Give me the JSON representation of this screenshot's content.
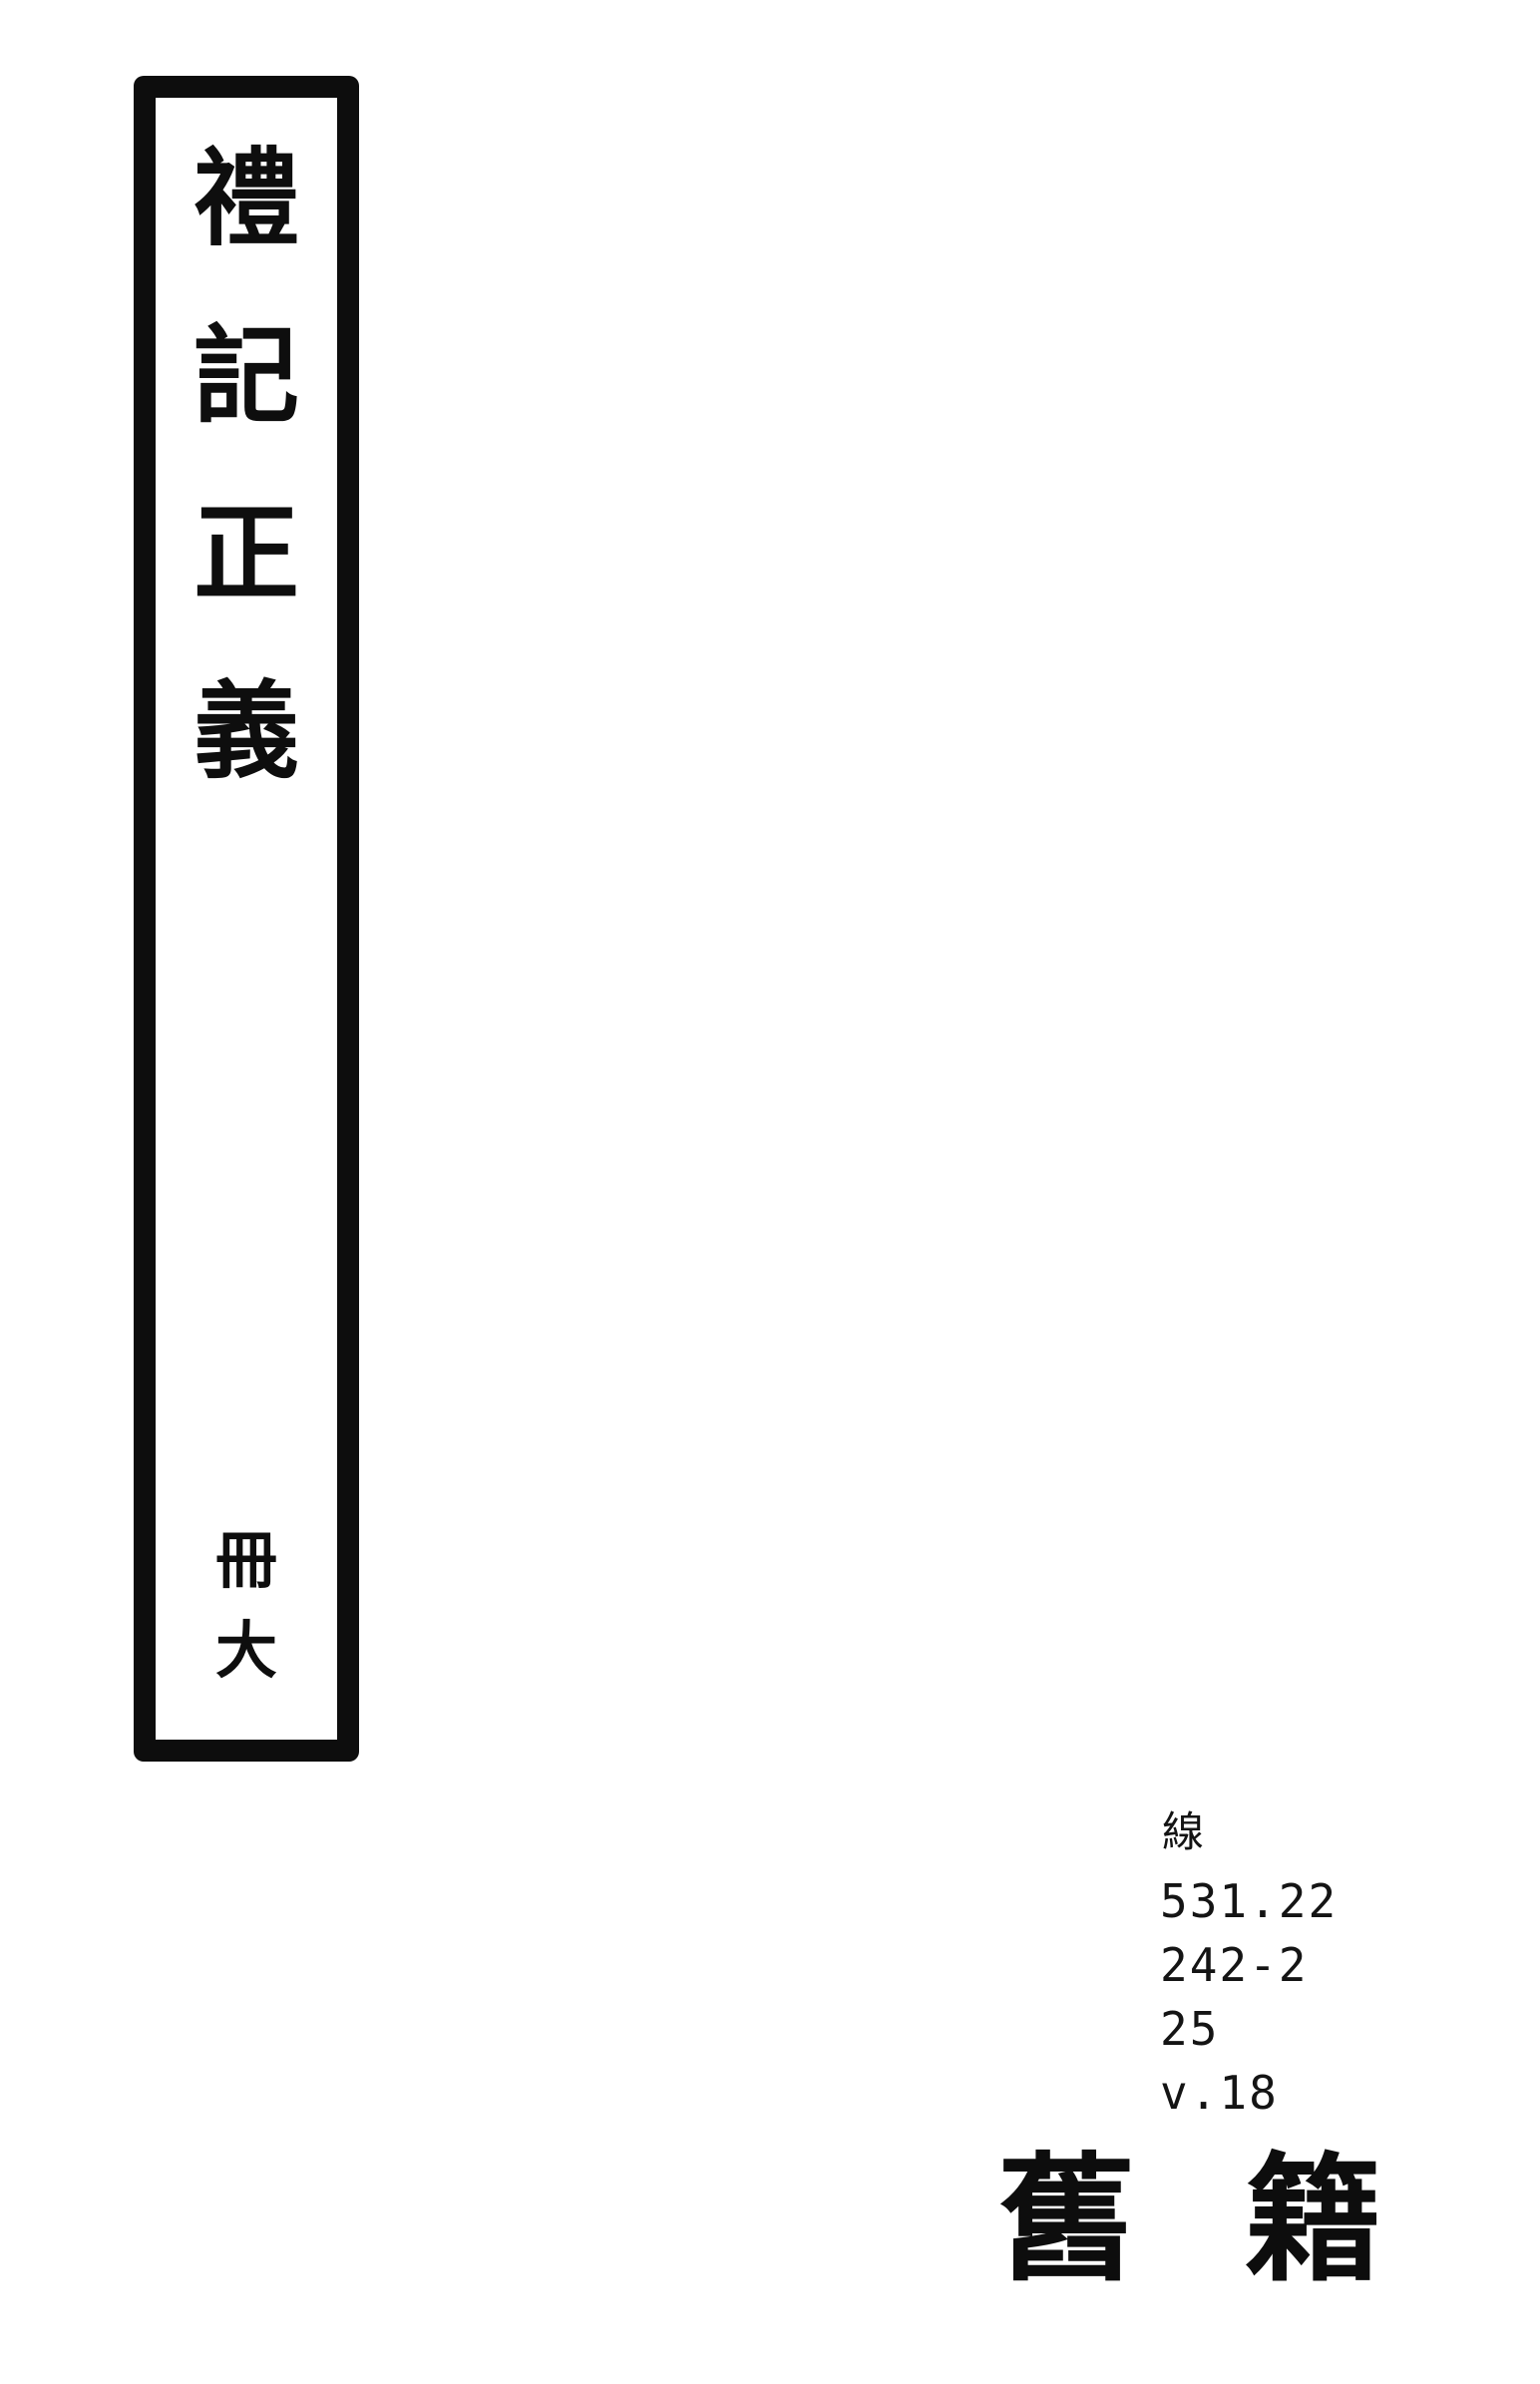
{
  "spine": {
    "title_text": "禮記正義",
    "title_chars": [
      "禮",
      "記",
      "正",
      "義"
    ],
    "volume_text": "冊大",
    "volume_chars": [
      "冊",
      "大"
    ]
  },
  "call_number": {
    "class_label": "線",
    "lines": [
      "531.22",
      "242-2",
      "25",
      "v.18"
    ]
  },
  "stamp": {
    "text": "舊籍",
    "left_char": "舊",
    "right_char": "籍"
  },
  "colors": {
    "ink": "#0d0d0d",
    "paper": "#ffffff"
  }
}
